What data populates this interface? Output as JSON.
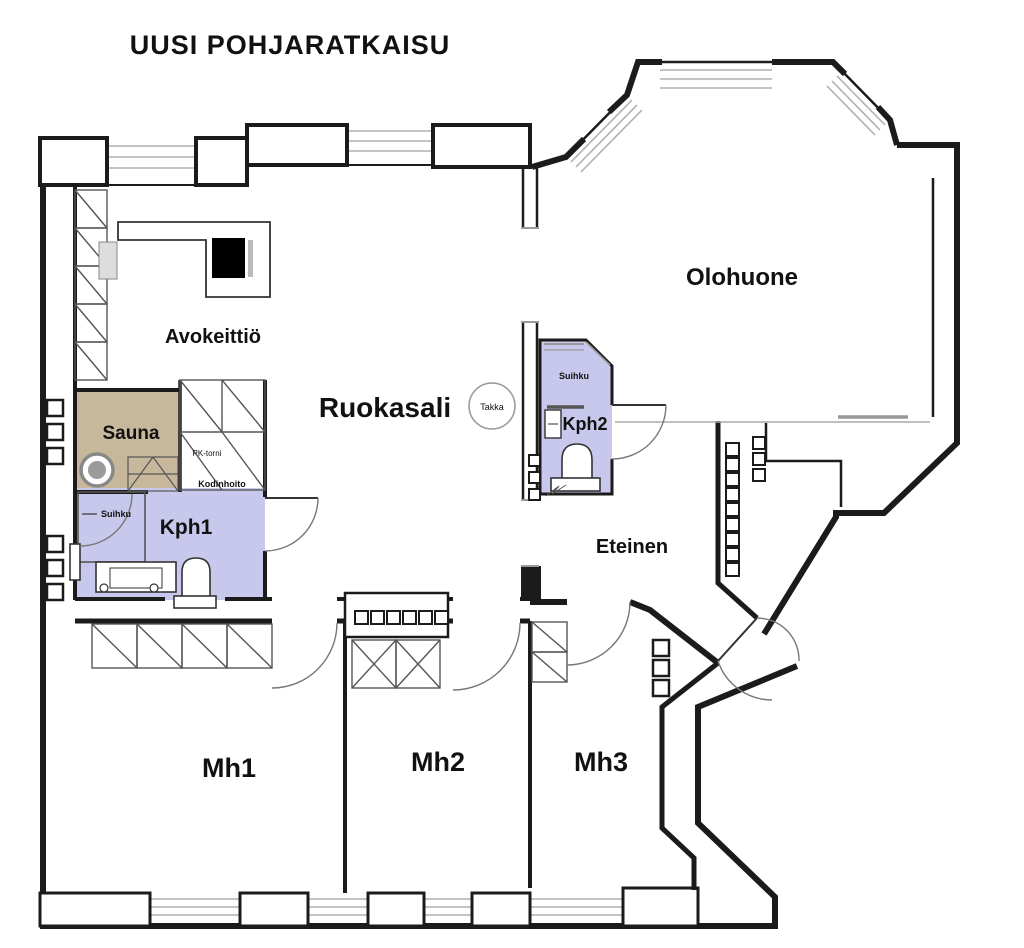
{
  "title": "UUSI POHJARATKAISU",
  "rooms": {
    "avokeittio": "Avokeittiö",
    "ruokasali": "Ruokasali",
    "olohuone": "Olohuone",
    "sauna": "Sauna",
    "kph1": "Kph1",
    "kph2": "Kph2",
    "eteinen": "Eteinen",
    "mh1": "Mh1",
    "mh2": "Mh2",
    "mh3": "Mh3"
  },
  "fixtures": {
    "fireplace": "Takka",
    "shower1": "Suihku",
    "shower2": "Suihku",
    "laundry_tower": "PK-torni",
    "utility": "Kodinhoito"
  },
  "colors": {
    "wall": "#1b1b1b",
    "wet_room": "#c8c8ec",
    "sauna": "#c8b89b",
    "window": "#b0b0b0",
    "background": "#ffffff"
  }
}
